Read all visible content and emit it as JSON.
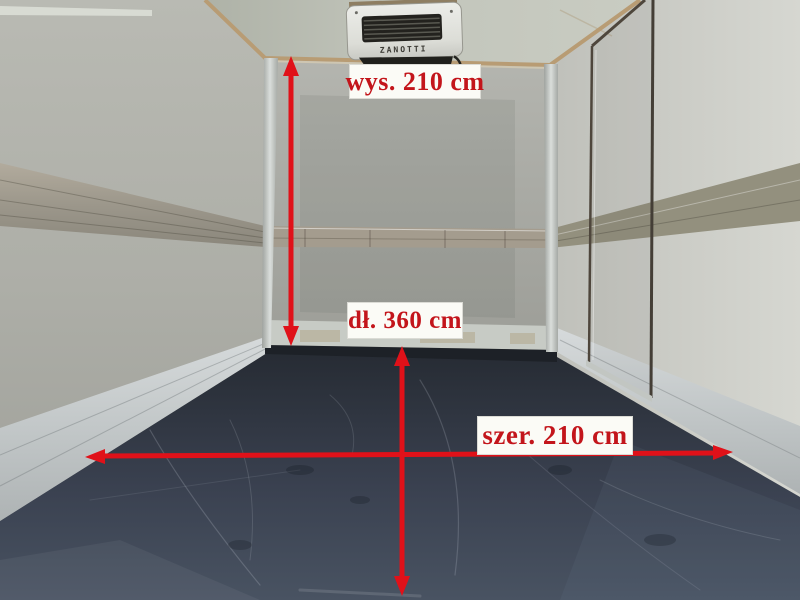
{
  "annotations": {
    "height": {
      "label": "wys. 210 cm"
    },
    "length": {
      "label": "dł. 360 cm"
    },
    "width": {
      "label": "szer. 210 cm"
    }
  },
  "refrigeration_unit": {
    "brand": "ZANOTTI"
  },
  "colors": {
    "arrow": "#e01119",
    "label_text": "#c3151b",
    "label_bg": "#fbfbf6",
    "wall": "#b0b1ab",
    "ceiling": "#bcc0b5",
    "floor_dark": "#2a2f38",
    "floor_light": "#4c5564",
    "trim_wood": "#b89c74",
    "rail_aluminum": "#c9cecf",
    "door_frame": "#4e463c"
  }
}
